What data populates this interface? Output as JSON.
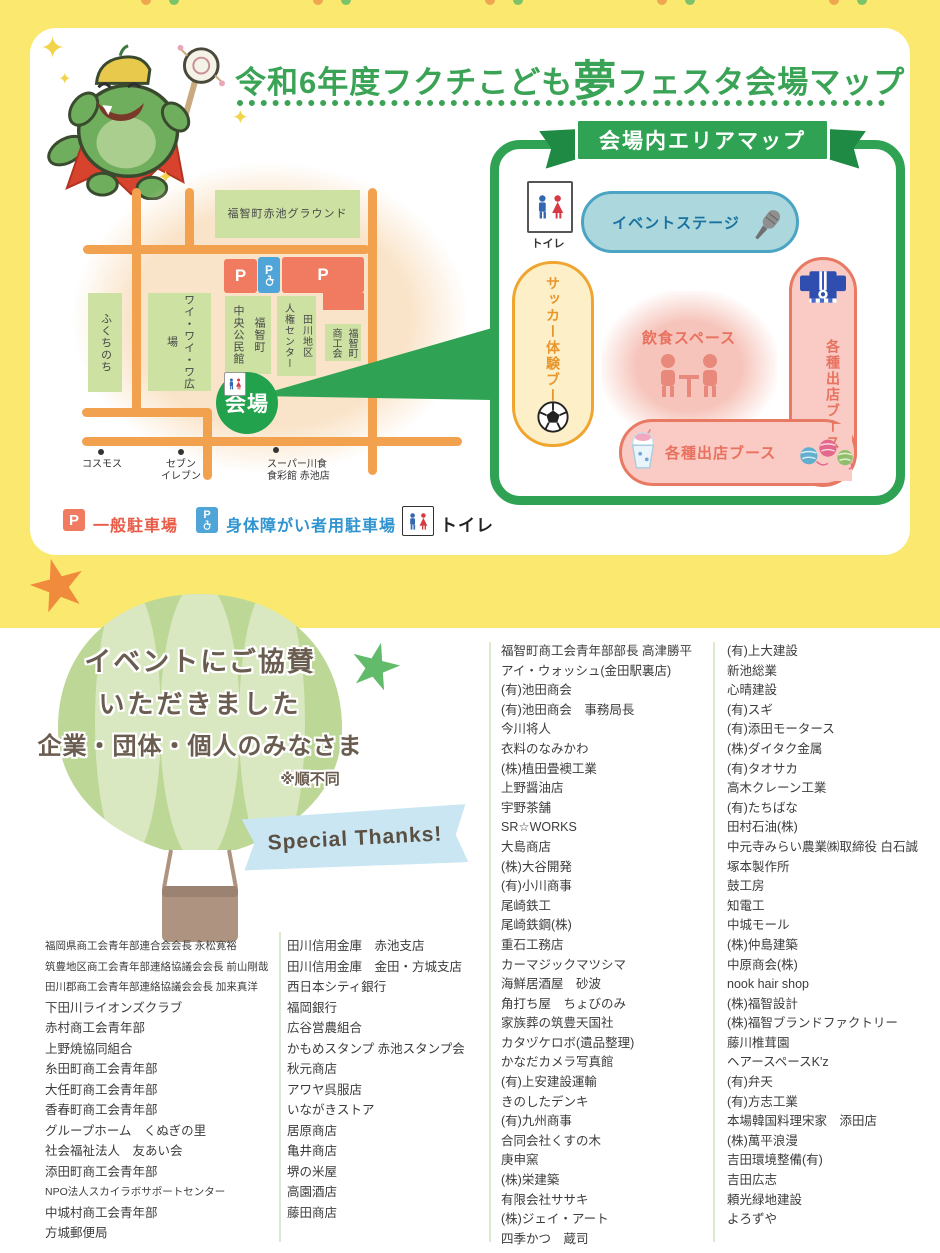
{
  "header": {
    "title_prefix": "令和6年度フクチこども",
    "title_emphasis": "夢",
    "title_suffix": "フェスタ会場マップ"
  },
  "street_map": {
    "ground": "福智町赤池グラウンド",
    "fukuchinochi": "ふくちのち",
    "plaza": "ワイ・ワイ・ワ広場",
    "hall": "福智町\n中央公民館",
    "jinken_center": "田川地区\n人権センター",
    "shokokai": "福智町\n商工会",
    "parking_letter": "P",
    "venue_label": "会場",
    "landmark1": "コスモス",
    "landmark2": "セブン\nイレブン",
    "landmark3": "スーパー川食\n食彩館 赤池店"
  },
  "area_map": {
    "banner": "会場内エリアマップ",
    "toilet_label": "トイレ",
    "stage_label": "イベントステージ",
    "soccer_label": "サッカー体験ブース",
    "food_label": "飲食スペース",
    "booth_side_label": "各種出店ブース",
    "booth_bottom_label": "各種出店ブース"
  },
  "legend": {
    "parking_letter": "P",
    "general": "一般駐車場",
    "accessible": "身体障がい者用駐車場",
    "toilet": "トイレ"
  },
  "sponsors": {
    "heading_line1": "イベントにご協賛",
    "heading_line2": "いただきました",
    "heading_line3": "企業・団体・個人のみなさま",
    "note": "※順不同",
    "special_thanks": "Special Thanks!",
    "col1": [
      "福岡県商工会青年部連合会会長 永松寛裕",
      "筑豊地区商工会青年部連絡協議会会長 前山剛哉",
      "田川郡商工会青年部連絡協議会会長 加来真洋",
      "下田川ライオンズクラブ",
      "赤村商工会青年部",
      "上野焼協同組合",
      "糸田町商工会青年部",
      "大任町商工会青年部",
      "香春町商工会青年部",
      "グループホーム　くぬぎの里",
      "社会福祉法人　友あい会",
      "添田町商工会青年部",
      "NPO法人スカイラボサポートセンター",
      "中城村商工会青年部",
      "方城郵便局"
    ],
    "col2": [
      "田川信用金庫　赤池支店",
      "田川信用金庫　金田・方城支店",
      "西日本シティ銀行",
      "福岡銀行",
      "広谷営農組合",
      "かもめスタンプ 赤池スタンプ会",
      "秋元商店",
      "アワヤ呉服店",
      "いながきストア",
      "居原商店",
      "亀井商店",
      "堺の米屋",
      "高園酒店",
      "藤田商店"
    ],
    "col3": [
      "福智町商工会青年部部長 高津勝平",
      "アイ・ウォッシュ(金田駅裏店)",
      "(有)池田商会",
      "(有)池田商会　事務局長",
      "今川将人",
      "衣料のなみかわ",
      "(株)植田畳襖工業",
      "上野醤油店",
      "宇野茶舗",
      "SR☆WORKS",
      "大島商店",
      "(株)大谷開発",
      "(有)小川商事",
      "尾崎鉄工",
      "尾崎鉄鋼(株)",
      "重石工務店",
      "カーマジックマツシマ",
      "海鮮居酒屋　砂波",
      "角打ち屋　ちょびのみ",
      "家族葬の筑豊天国社",
      "カタヅケロボ(遺品整理)",
      "かなだカメラ写真館",
      "(有)上安建設運輸",
      "きのしたデンキ",
      "(有)九州商事",
      "合同会社くすの木",
      "庚申窯",
      "(株)栄建築",
      "有限会社ササキ",
      "(株)ジェイ・アート",
      "四季かつ　蔵司"
    ],
    "col4": [
      "(有)上大建設",
      "新池総業",
      "心晴建設",
      "(有)スギ",
      "(有)添田モータース",
      "(株)ダイタク金属",
      "(有)タオサカ",
      "高木クレーン工業",
      "(有)たちばな",
      "田村石油(株)",
      "中元寺みらい農業㈱取締役 白石誠",
      "塚本製作所",
      "鼓工房",
      "知電工",
      "中城モール",
      "(株)仲島建築",
      "中原商会(株)",
      "nook hair shop",
      "(株)福智設計",
      "(株)福智ブランドファクトリー",
      "藤川椎茸園",
      "ヘアースペースK'z",
      "(有)弁天",
      "(有)方志工業",
      "本場韓国料理宋家　添田店",
      "(株)萬平浪漫",
      "吉田環境整備(有)",
      "吉田広志",
      "頼光緑地建設",
      "よろずや"
    ]
  }
}
